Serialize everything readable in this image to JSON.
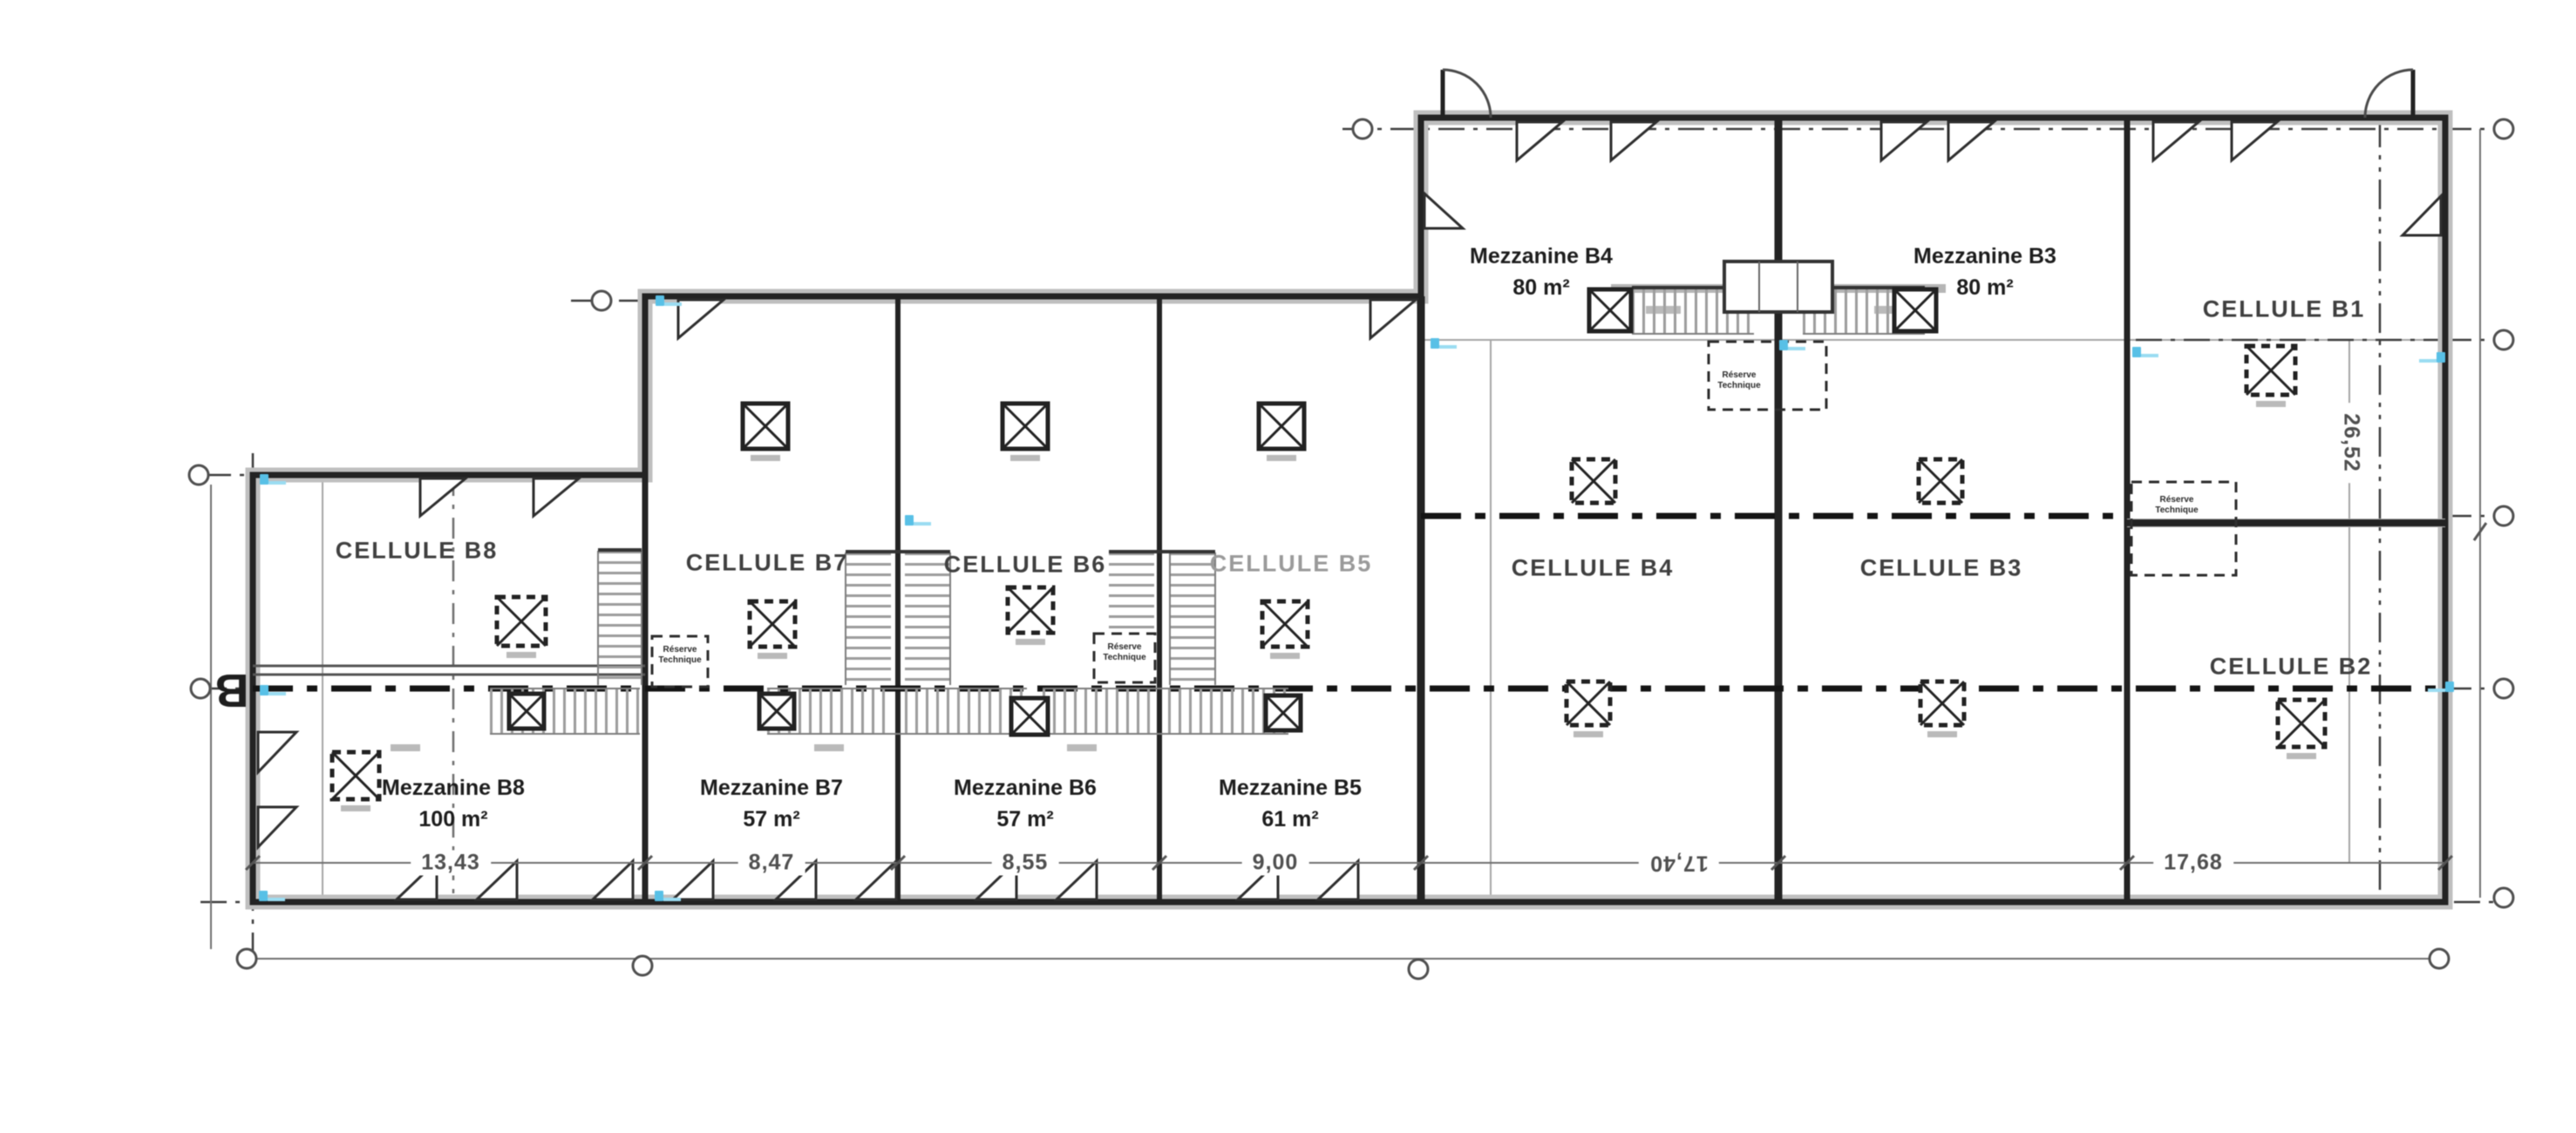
{
  "cells": {
    "b1": "CELLULE B1",
    "b2": "CELLULE B2",
    "b3": "CELLULE B3",
    "b4": "CELLULE B4",
    "b5": "CELLULE B5",
    "b6": "CELLULE B6",
    "b7": "CELLULE B7",
    "b8": "CELLULE B8"
  },
  "mezzanines": {
    "b3": {
      "name": "Mezzanine B3",
      "area": "80 m²"
    },
    "b4": {
      "name": "Mezzanine B4",
      "area": "80 m²"
    },
    "b5": {
      "name": "Mezzanine B5",
      "area": "61 m²"
    },
    "b6": {
      "name": "Mezzanine B6",
      "area": "57 m²"
    },
    "b7": {
      "name": "Mezzanine B7",
      "area": "57 m²"
    },
    "b8": {
      "name": "Mezzanine B8",
      "area": "100 m²"
    }
  },
  "dimensions": {
    "cell_b8_width": "13,43",
    "cell_b7_width": "8,47",
    "cell_b6_width": "8,55",
    "cell_b5_width": "9,00",
    "cells_b4_b3_width": "17,40",
    "cells_b1_b2_width": "17,68",
    "right_wing_depth": "26,52"
  },
  "annotations": {
    "technical_room_line1": "Réserve",
    "technical_room_line2": "Technique",
    "grid_axis_label": "B"
  }
}
